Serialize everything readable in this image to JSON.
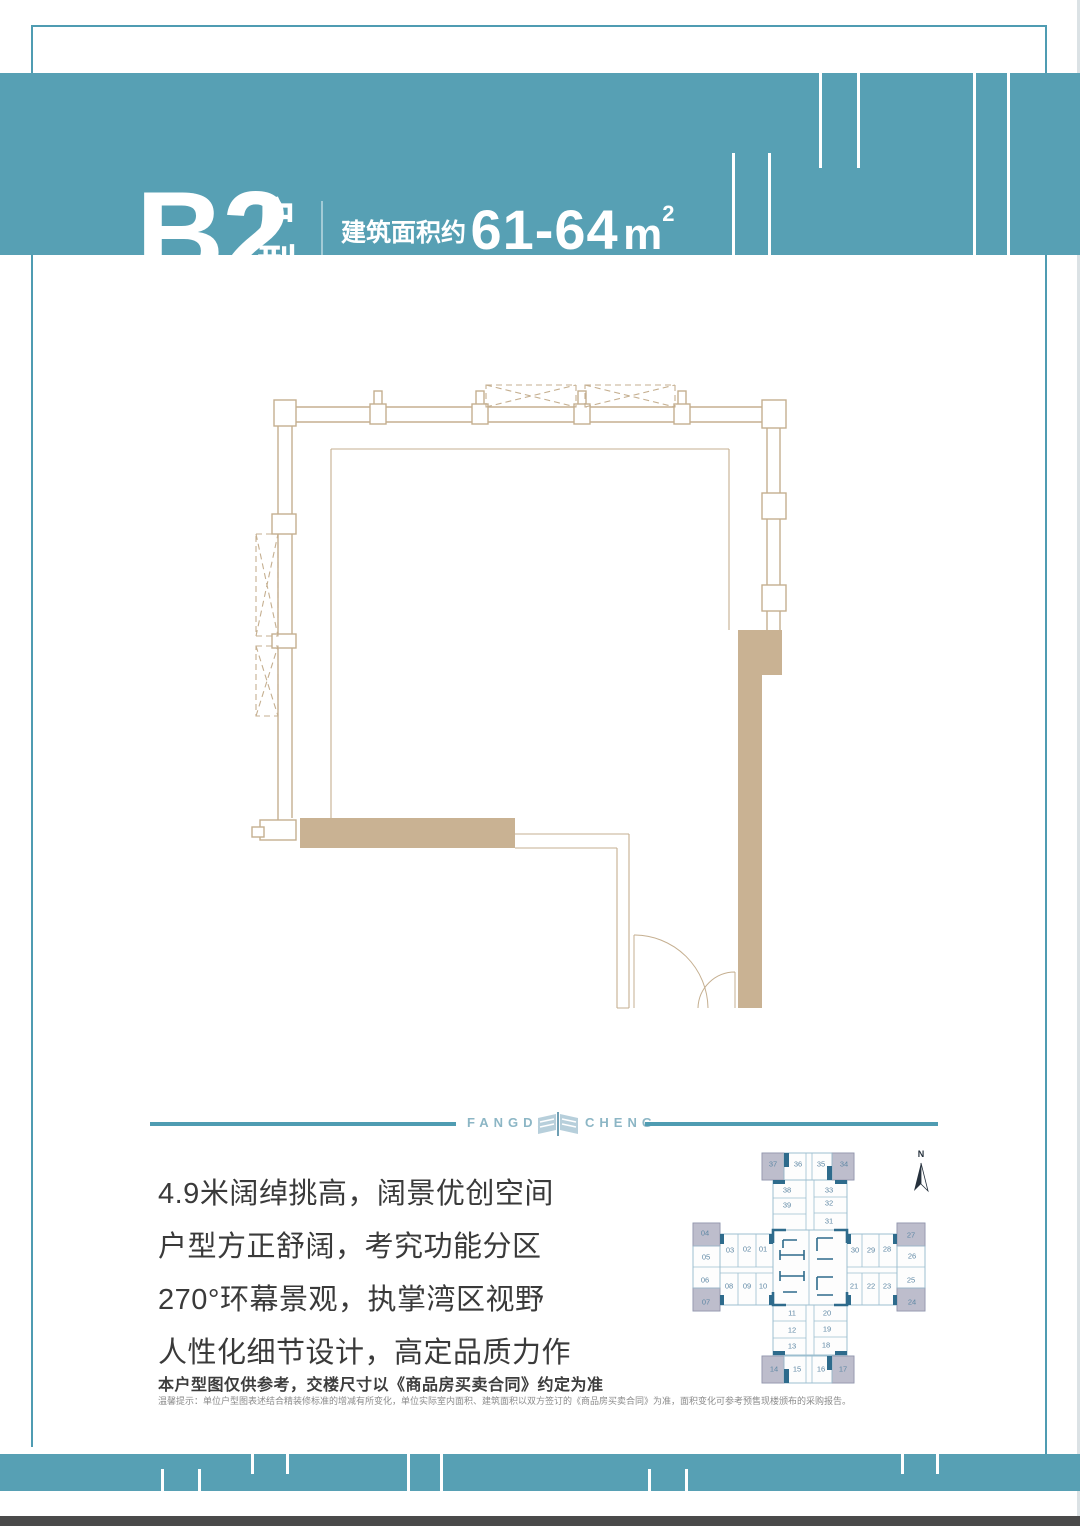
{
  "header": {
    "unit_code": "B2",
    "unit_suffix": "户型",
    "room_numbers": "(房号：04/07/14/17/24/27/34/37)",
    "area_label_1": "建筑面积约",
    "area_value_1": "61-64",
    "area_unit_base": "m",
    "area_unit_sup": "2",
    "area_line_2": "建筑面积约 657-689 呎"
  },
  "brand": {
    "left": "FANGDA",
    "right": "CHENG"
  },
  "features": [
    "4.9米阔绰挑高，阔景优创空间",
    "户型方正舒阔，考究功能分区",
    "270°环幕景观，执掌湾区视野",
    "人性化细节设计，高定品质力作"
  ],
  "disclaimer": {
    "main": "本户型图仅供参考，交楼尺寸以《商品房买卖合同》约定为准",
    "fine_print": "温馨提示：单位户型图表述结合精装修标准的增减有所变化，单位实际室内面积、建筑面积以双方签订的《商品房买卖合同》为准，面积变化可参考预售现楼颁布的采购报告。"
  },
  "keyplan": {
    "north_label": "N",
    "cells": [
      {
        "label": "37",
        "highlight": true
      },
      {
        "label": "36",
        "highlight": false
      },
      {
        "label": "35",
        "highlight": false
      },
      {
        "label": "34",
        "highlight": true
      },
      {
        "label": "38",
        "highlight": false
      },
      {
        "label": "33",
        "highlight": false
      },
      {
        "label": "39",
        "highlight": false
      },
      {
        "label": "32",
        "highlight": false
      },
      {
        "label": "31",
        "highlight": false
      },
      {
        "label": "04",
        "highlight": true
      },
      {
        "label": "05",
        "highlight": false
      },
      {
        "label": "06",
        "highlight": false
      },
      {
        "label": "07",
        "highlight": true
      },
      {
        "label": "03",
        "highlight": false
      },
      {
        "label": "02",
        "highlight": false
      },
      {
        "label": "01",
        "highlight": false
      },
      {
        "label": "08",
        "highlight": false
      },
      {
        "label": "09",
        "highlight": false
      },
      {
        "label": "10",
        "highlight": false
      },
      {
        "label": "30",
        "highlight": false
      },
      {
        "label": "29",
        "highlight": false
      },
      {
        "label": "28",
        "highlight": false
      },
      {
        "label": "21",
        "highlight": false
      },
      {
        "label": "22",
        "highlight": false
      },
      {
        "label": "23",
        "highlight": false
      },
      {
        "label": "27",
        "highlight": true
      },
      {
        "label": "26",
        "highlight": false
      },
      {
        "label": "25",
        "highlight": false
      },
      {
        "label": "24",
        "highlight": true
      },
      {
        "label": "11",
        "highlight": false
      },
      {
        "label": "20",
        "highlight": false
      },
      {
        "label": "12",
        "highlight": false
      },
      {
        "label": "19",
        "highlight": false
      },
      {
        "label": "13",
        "highlight": false
      },
      {
        "label": "18",
        "highlight": false
      },
      {
        "label": "14",
        "highlight": true
      },
      {
        "label": "15",
        "highlight": false
      },
      {
        "label": "16",
        "highlight": false
      },
      {
        "label": "17",
        "highlight": true
      }
    ]
  },
  "colors": {
    "band_teal": "#57a0b4",
    "frame_teal": "#4f9cb2",
    "plan_tan": "#c9b293",
    "plan_tan_line": "#c5af90",
    "keyplan_dark": "#2e6b8c",
    "keyplan_shaded": "#bdbdcc",
    "brand_text": "#8cb6c5"
  }
}
